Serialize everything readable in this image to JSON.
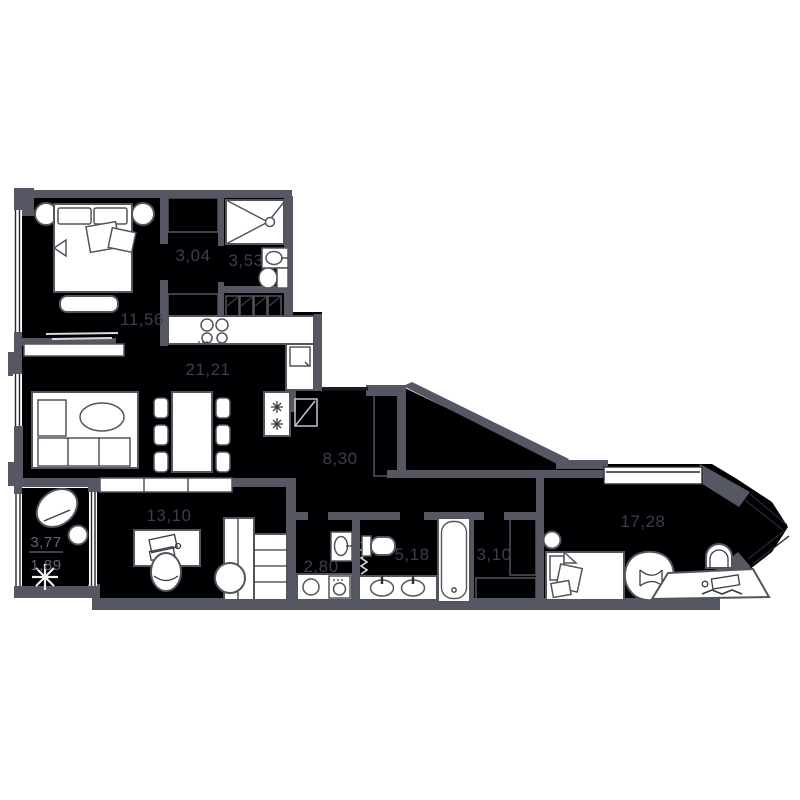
{
  "plan": {
    "title": "apartment-floor-plan",
    "units": "m2-with-comma-decimal",
    "colors": {
      "background": "#ffffff",
      "floor": "#000003",
      "wall": "#555862",
      "furniture_outline": "#53555d",
      "label": "#3d3f48",
      "balcony_label": "#63656d"
    },
    "rooms": {
      "bedroom": {
        "area": "11,56"
      },
      "dressing": {
        "area": "3,04"
      },
      "shower_room": {
        "area": "3,53"
      },
      "kitchen_living": {
        "area": "21,21"
      },
      "hallway": {
        "area": "8,30"
      },
      "study": {
        "area": "13,10"
      },
      "balcony": {
        "area_full": "3,77",
        "area_counted": "1,89"
      },
      "wc": {
        "area": "2,80"
      },
      "bathroom": {
        "area": "5,18"
      },
      "closet": {
        "area": "3,10"
      },
      "bedroom2": {
        "area": "17,28"
      }
    }
  }
}
